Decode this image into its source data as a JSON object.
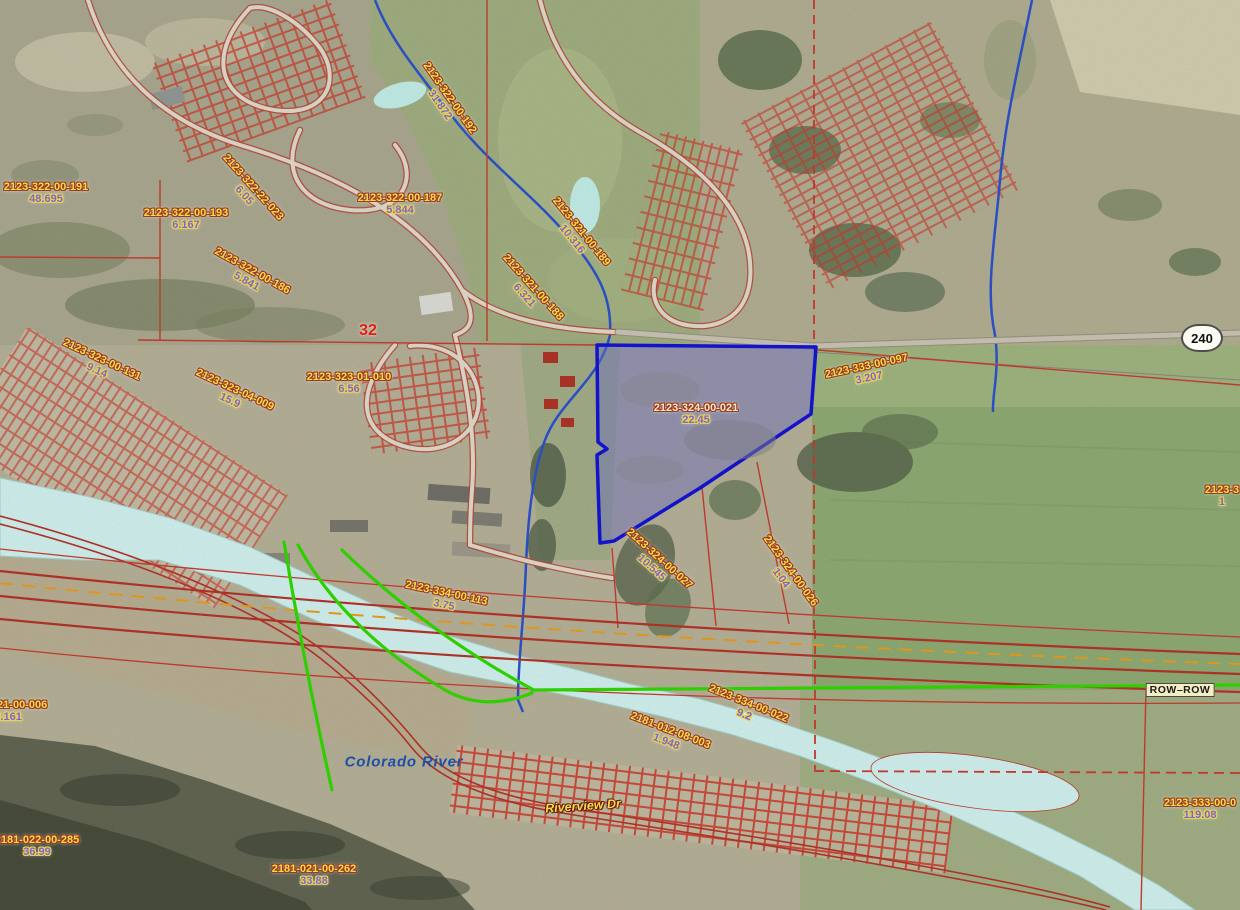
{
  "map_type": "county-parcel-gis-aerial-view",
  "annotations": {
    "section_number": "32",
    "route_shield": "240",
    "row_label": "ROW–ROW",
    "river_label": "Colorado River",
    "street_label": "Riverview Dr"
  },
  "highlighted_parcel": {
    "id": "2123-324-00-021",
    "acreage": "22.45"
  },
  "parcel_labels": [
    {
      "id": "2123-322-00-191",
      "acreage": "48.695",
      "x": 46,
      "y": 194,
      "rot": 0
    },
    {
      "id": "2123-322-00-193",
      "acreage": "6.167",
      "x": 186,
      "y": 220,
      "rot": 0
    },
    {
      "id": "2123-322-22-023",
      "acreage": "6.05",
      "x": 248,
      "y": 192,
      "rot": 48
    },
    {
      "id": "2123-322-00-187",
      "acreage": "5.844",
      "x": 400,
      "y": 205,
      "rot": 0
    },
    {
      "id": "2123-322-00-186",
      "acreage": "5.841",
      "x": 249,
      "y": 277,
      "rot": 29
    },
    {
      "id": "2123-322-00-192",
      "acreage": "31.872",
      "x": 444,
      "y": 102,
      "rot": 55
    },
    {
      "id": "2123-321-00-189",
      "acreage": "10.316",
      "x": 576,
      "y": 236,
      "rot": 51
    },
    {
      "id": "2123-321-00-188",
      "acreage": "6.321",
      "x": 528,
      "y": 292,
      "rot": 48
    },
    {
      "id": "2123-323-01-010",
      "acreage": "6.56",
      "x": 349,
      "y": 384,
      "rot": 0
    },
    {
      "id": "2123-323-00-131",
      "acreage": "9.14",
      "x": 99,
      "y": 366,
      "rot": 25
    },
    {
      "id": "2123-323-04-009",
      "acreage": "15.9",
      "x": 232,
      "y": 396,
      "rot": 25
    },
    {
      "id": "2123-324-00-021",
      "acreage": "22.45",
      "x": 696,
      "y": 415,
      "rot": 0,
      "highlight": true
    },
    {
      "id": "2123-333-00-097",
      "acreage": "3.207",
      "x": 868,
      "y": 373,
      "rot": -12
    },
    {
      "id": "2123-334-00-113",
      "acreage": "3.75",
      "x": 445,
      "y": 600,
      "rot": 12
    },
    {
      "id": "2123-324-00-027",
      "acreage": "10.545",
      "x": 655,
      "y": 564,
      "rot": 42
    },
    {
      "id": "2123-324-00-026",
      "acreage": "1.04",
      "x": 785,
      "y": 575,
      "rot": 54
    },
    {
      "id": "2123-334-00-022",
      "acreage": "9.2",
      "x": 746,
      "y": 710,
      "rot": 22
    },
    {
      "id": "2181-012-08-003",
      "acreage": "1.948",
      "x": 668,
      "y": 737,
      "rot": 21
    },
    {
      "id": "2123-321-00-006",
      "acreage": "43.161",
      "x": 5,
      "y": 712,
      "rot": 0
    },
    {
      "id": "2181-022-00-285",
      "acreage": "36.99",
      "x": 37,
      "y": 847,
      "rot": 0
    },
    {
      "id": "2181-021-00-262",
      "acreage": "33.88",
      "x": 314,
      "y": 876,
      "rot": 0
    },
    {
      "id": "2123-333-00-0",
      "acreage": "119.08",
      "x": 1200,
      "y": 810,
      "rot": 0
    },
    {
      "id": "2123-3",
      "acreage": "1",
      "x": 1222,
      "y": 497,
      "rot": 0
    }
  ],
  "colors": {
    "parcel_line_red": "#c23b2e",
    "highlight_outline_blue": "#1313cf",
    "highlight_fill": "rgba(104,108,196,0.45)",
    "river_water_cyan": "#cdecea",
    "creek_blue": "#2b50c8",
    "route_highlight_green": "#2fd400",
    "centerline_orange": "#e39a1e",
    "label_id_yellow": "#f5dd4a",
    "label_acreage_purple": "#7e63d6"
  }
}
